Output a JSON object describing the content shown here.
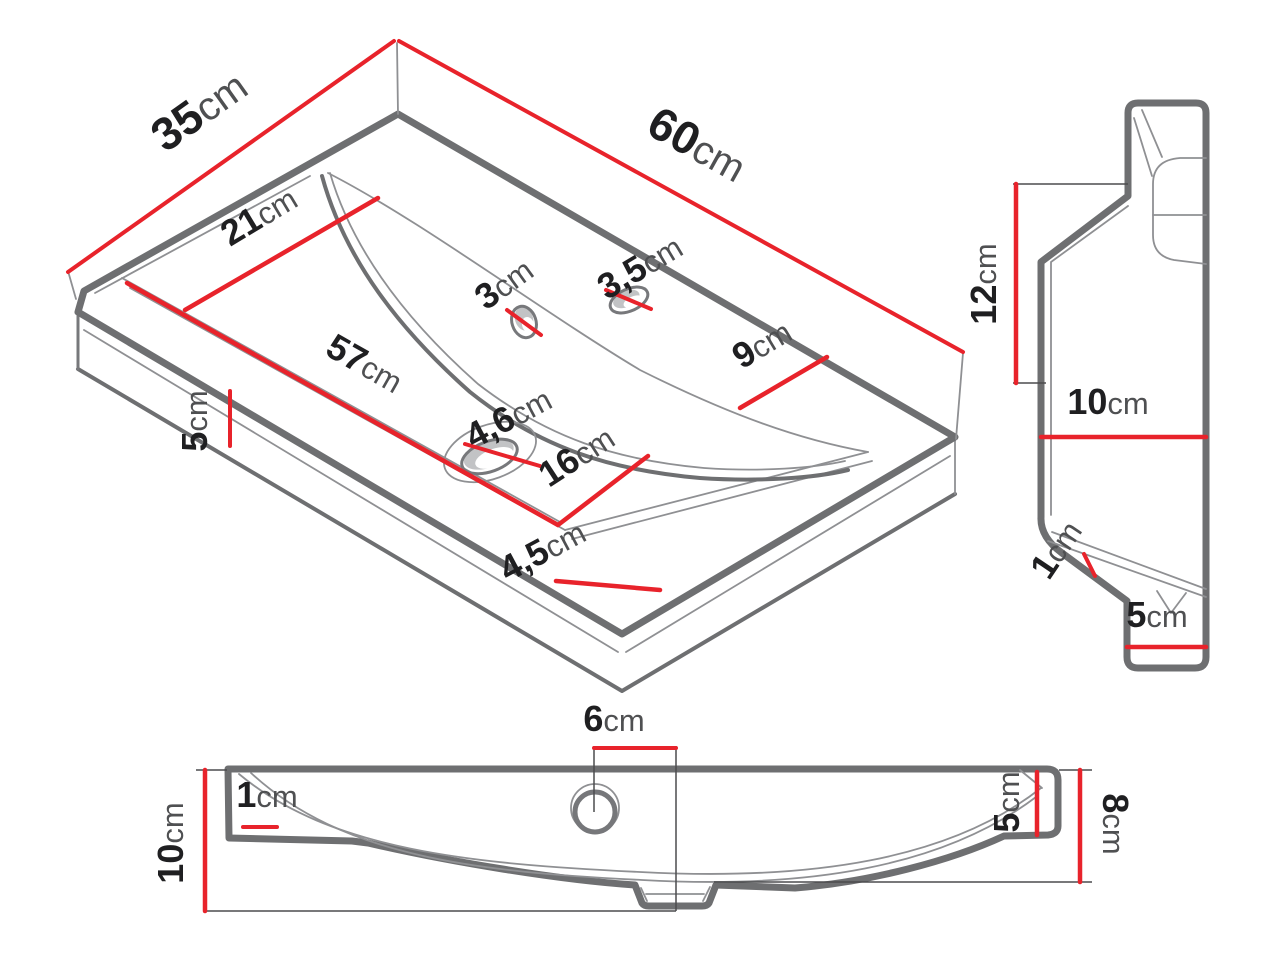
{
  "colors": {
    "background": "#ffffff",
    "outline_gray": "#6e6f71",
    "thin_line_gray": "#8f9093",
    "dimension_red": "#e8232b",
    "number_color": "#1f1f21",
    "unit_color": "#4f5052"
  },
  "views": {
    "iso": {
      "dims": {
        "d35": {
          "num": "35",
          "unit": "cm"
        },
        "d60": {
          "num": "60",
          "unit": "cm"
        },
        "d21": {
          "num": "21",
          "unit": "cm"
        },
        "d3": {
          "num": "3",
          "unit": "cm"
        },
        "d3_5": {
          "num": "3,5",
          "unit": "cm"
        },
        "d9": {
          "num": "9",
          "unit": "cm"
        },
        "d57": {
          "num": "57",
          "unit": "cm"
        },
        "d5": {
          "num": "5",
          "unit": "cm"
        },
        "d4_6": {
          "num": "4,6",
          "unit": "cm"
        },
        "d16": {
          "num": "16",
          "unit": "cm"
        },
        "d4_5": {
          "num": "4,5",
          "unit": "cm"
        }
      }
    },
    "side": {
      "dims": {
        "d12": {
          "num": "12",
          "unit": "cm"
        },
        "d10": {
          "num": "10",
          "unit": "cm"
        },
        "d1": {
          "num": "1",
          "unit": "cm"
        },
        "d5": {
          "num": "5",
          "unit": "cm"
        }
      }
    },
    "front": {
      "dims": {
        "d6": {
          "num": "6",
          "unit": "cm"
        },
        "d1": {
          "num": "1",
          "unit": "cm"
        },
        "d10": {
          "num": "10",
          "unit": "cm"
        },
        "d5": {
          "num": "5",
          "unit": "cm"
        },
        "d8": {
          "num": "8",
          "unit": "cm"
        }
      }
    }
  }
}
